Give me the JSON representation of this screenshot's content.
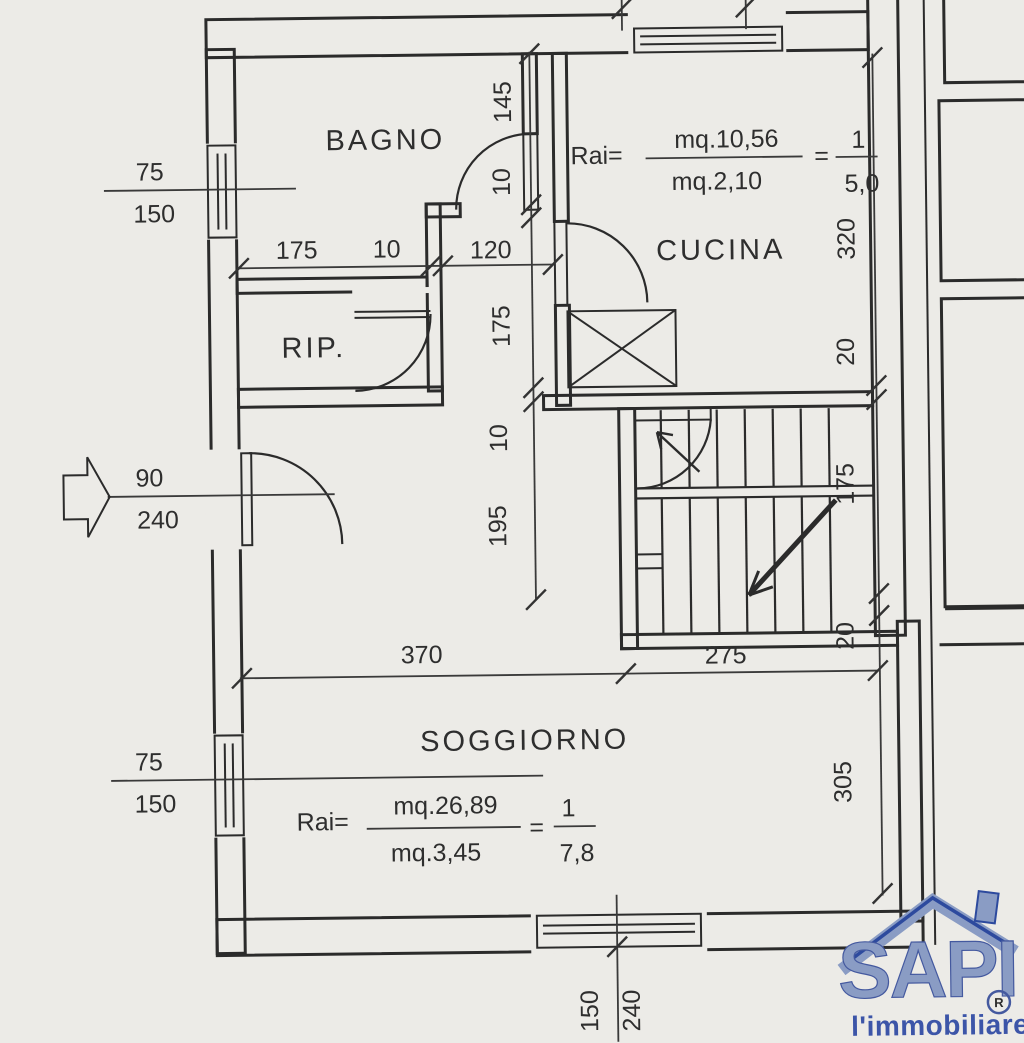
{
  "rooms": {
    "bagno": "BAGNO",
    "cucina": "CUCINA",
    "rip": "RIP.",
    "soggiorno": "SOGGIORNO"
  },
  "formulas": {
    "cucina": {
      "label": "Rai=",
      "numerator": "mq.10,56",
      "denominator": "mq.2,10",
      "equals": "=",
      "result_num": "1",
      "result_den": "5,0"
    },
    "soggiorno": {
      "label": "Rai=",
      "numerator": "mq.26,89",
      "denominator": "mq.3,45",
      "equals": "=",
      "result_num": "1",
      "result_den": "7,8"
    }
  },
  "dims": {
    "bagno_win_top": "75",
    "bagno_win_bot": "150",
    "h175": "175",
    "h10": "10",
    "h120": "120",
    "v145": "145",
    "v10a": "10",
    "v175": "175",
    "v10b": "10",
    "v195": "195",
    "r320": "320",
    "r20a": "20",
    "r175": "175",
    "r20b": "20",
    "r305": "305",
    "door90": "90",
    "door240": "240",
    "b370": "370",
    "b275": "275",
    "sogg_win_top": "75",
    "sogg_win_bot": "150",
    "bc150": "150",
    "bc240": "240"
  },
  "logo": {
    "brand": "SAPI",
    "registered": "R",
    "tagline": "l'immobiliare"
  },
  "colors": {
    "paper": "#ecebe7",
    "ink": "#2b2b2b",
    "logo_fill": "#8a9cc4",
    "logo_text": "#3c55a8"
  }
}
